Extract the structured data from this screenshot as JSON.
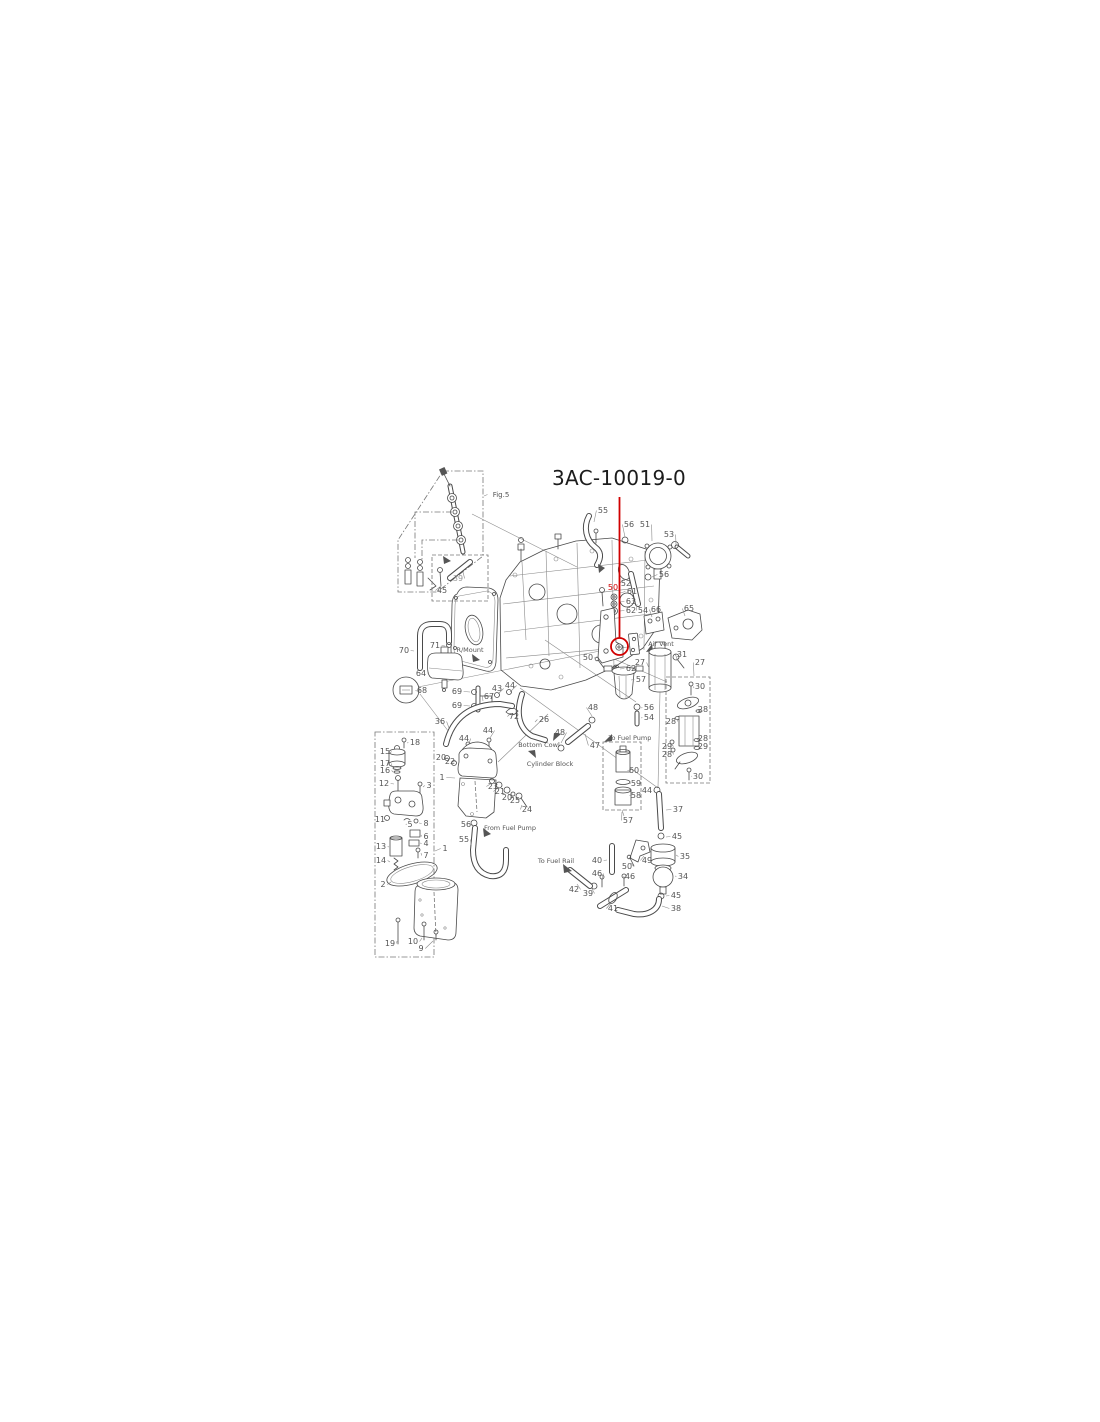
{
  "title": {
    "part_number": "3AC-10019-0"
  },
  "highlight": {
    "color": "#d10000",
    "leader_line": {
      "x": 619.5,
      "y1": 497,
      "y2": 637.5
    },
    "circle": {
      "x": 619.5,
      "y": 646.5,
      "r": 8.5
    },
    "highlighted_item": "50"
  },
  "labels": [
    {
      "t": "Fig.5",
      "x": 501,
      "y": 497,
      "fs": 7,
      "lx": 484,
      "ly": 496
    },
    {
      "t": "39",
      "x": 458,
      "y": 581,
      "c": "#999999",
      "lx": 463,
      "ly": 572
    },
    {
      "t": "45",
      "x": 442,
      "y": 593,
      "lx": 441,
      "ly": 586
    },
    {
      "t": "55",
      "x": 603,
      "y": 513,
      "lx": 594,
      "ly": 522
    },
    {
      "t": "56",
      "x": 629,
      "y": 527,
      "lx": 625,
      "ly": 537
    },
    {
      "t": "51",
      "x": 645,
      "y": 527,
      "lx": 652,
      "ly": 541
    },
    {
      "t": "53",
      "x": 669,
      "y": 537,
      "lx": 676,
      "ly": 545
    },
    {
      "t": "52",
      "x": 626,
      "y": 586,
      "lx": 624,
      "ly": 579
    },
    {
      "t": "56",
      "x": 664,
      "y": 577,
      "lx": 652,
      "ly": 577
    },
    {
      "t": "50",
      "x": 613,
      "y": 590,
      "c": "#d10000"
    },
    {
      "t": "61",
      "x": 632,
      "y": 594,
      "lx": 620,
      "ly": 593
    },
    {
      "t": "63",
      "x": 631,
      "y": 604,
      "lx": 620,
      "ly": 602
    },
    {
      "t": "62",
      "x": 631,
      "y": 613,
      "lx": 620,
      "ly": 611
    },
    {
      "t": "54",
      "x": 643,
      "y": 613,
      "lx": 637,
      "ly": 604
    },
    {
      "t": "66",
      "x": 656,
      "y": 612,
      "lx": 652,
      "ly": 617
    },
    {
      "t": "65",
      "x": 689,
      "y": 611,
      "lx": 685,
      "ly": 616
    },
    {
      "t": "Air Vent",
      "x": 661,
      "y": 646,
      "fs": 6.5
    },
    {
      "t": "50",
      "x": 588,
      "y": 660,
      "lx": 596,
      "ly": 661
    },
    {
      "t": "27",
      "x": 640,
      "y": 665,
      "lx": 649,
      "ly": 668
    },
    {
      "t": "62",
      "x": 631,
      "y": 671,
      "lx": 620,
      "ly": 669
    },
    {
      "t": "31",
      "x": 682,
      "y": 657,
      "lx": 678,
      "ly": 661
    },
    {
      "t": "27",
      "x": 700,
      "y": 665,
      "lx": 694,
      "ly": 676
    },
    {
      "t": "57",
      "x": 641,
      "y": 682,
      "lx": 631,
      "ly": 680
    },
    {
      "t": "56",
      "x": 649,
      "y": 710,
      "lx": 641,
      "ly": 708
    },
    {
      "t": "54",
      "x": 649,
      "y": 720,
      "lx": 641,
      "ly": 718
    },
    {
      "t": "To Fuel Pump",
      "x": 630,
      "y": 740,
      "fs": 6.5
    },
    {
      "t": "48",
      "x": 593,
      "y": 710,
      "lx": 592,
      "ly": 716
    },
    {
      "t": "47",
      "x": 595,
      "y": 748,
      "lx": 585,
      "ly": 734
    },
    {
      "t": "48",
      "x": 560,
      "y": 735,
      "lx": 561,
      "ly": 743
    },
    {
      "t": "26",
      "x": 544,
      "y": 722,
      "lx": 535,
      "ly": 722
    },
    {
      "t": "72",
      "x": 514,
      "y": 719,
      "lx": 510,
      "ly": 714
    },
    {
      "t": "Bottom Cowl",
      "x": 539,
      "y": 747,
      "fs": 6.5
    },
    {
      "t": "Cylinder Block",
      "x": 550,
      "y": 766,
      "fs": 6.5
    },
    {
      "t": "30",
      "x": 700,
      "y": 689,
      "lx": 694,
      "ly": 688
    },
    {
      "t": "28",
      "x": 703,
      "y": 712,
      "lx": 700,
      "ly": 711
    },
    {
      "t": "28",
      "x": 671,
      "y": 724,
      "lx": 677,
      "ly": 719
    },
    {
      "t": "28",
      "x": 703,
      "y": 741,
      "lx": 699,
      "ly": 741
    },
    {
      "t": "29",
      "x": 703,
      "y": 749,
      "lx": 699,
      "ly": 747
    },
    {
      "t": "29",
      "x": 667,
      "y": 749,
      "lx": 671,
      "ly": 744
    },
    {
      "t": "28",
      "x": 667,
      "y": 757,
      "lx": 672,
      "ly": 751
    },
    {
      "t": "30",
      "x": 698,
      "y": 779,
      "lx": 692,
      "ly": 776
    },
    {
      "t": "60",
      "x": 634,
      "y": 773,
      "lx": 630,
      "ly": 770
    },
    {
      "t": "59",
      "x": 636,
      "y": 786,
      "lx": 631,
      "ly": 783
    },
    {
      "t": "58",
      "x": 636,
      "y": 798,
      "lx": 632,
      "ly": 795
    },
    {
      "t": "57",
      "x": 628,
      "y": 823,
      "lx": 622,
      "ly": 812
    },
    {
      "t": "44",
      "x": 647,
      "y": 793,
      "lx": 654,
      "ly": 791
    },
    {
      "t": "37",
      "x": 678,
      "y": 812,
      "lx": 666,
      "ly": 810
    },
    {
      "t": "45",
      "x": 677,
      "y": 839,
      "lx": 666,
      "ly": 837
    },
    {
      "t": "35",
      "x": 685,
      "y": 859,
      "lx": 676,
      "ly": 855
    },
    {
      "t": "34",
      "x": 683,
      "y": 879,
      "lx": 675,
      "ly": 876
    },
    {
      "t": "45",
      "x": 676,
      "y": 898,
      "lx": 666,
      "ly": 896
    },
    {
      "t": "38",
      "x": 676,
      "y": 911,
      "lx": 662,
      "ly": 906
    },
    {
      "t": "40",
      "x": 597,
      "y": 863,
      "lx": 607,
      "ly": 860
    },
    {
      "t": "50",
      "x": 627,
      "y": 869,
      "lx": 631,
      "ly": 863
    },
    {
      "t": "49",
      "x": 647,
      "y": 863,
      "lx": 644,
      "ly": 856
    },
    {
      "t": "46",
      "x": 630,
      "y": 879,
      "lx": 626,
      "ly": 878
    },
    {
      "t": "46",
      "x": 597,
      "y": 876,
      "lx": 602,
      "ly": 879
    },
    {
      "t": "42",
      "x": 574,
      "y": 892,
      "lx": 577,
      "ly": 884
    },
    {
      "t": "39",
      "x": 588,
      "y": 896,
      "lx": 592,
      "ly": 889
    },
    {
      "t": "41",
      "x": 613,
      "y": 911,
      "lx": 611,
      "ly": 903
    },
    {
      "t": "To Fuel Rail",
      "x": 556,
      "y": 863,
      "fs": 6.5
    },
    {
      "t": "From Fuel Pump",
      "x": 510,
      "y": 830,
      "fs": 6.5
    },
    {
      "t": "56",
      "x": 466,
      "y": 827,
      "lx": 471,
      "ly": 824
    },
    {
      "t": "55",
      "x": 464,
      "y": 842,
      "lx": 471,
      "ly": 845
    },
    {
      "t": "70",
      "x": 404,
      "y": 653,
      "lx": 414,
      "ly": 651
    },
    {
      "t": "71",
      "x": 435,
      "y": 648,
      "lx": 445,
      "ly": 646
    },
    {
      "t": "R/Mount",
      "x": 470,
      "y": 652,
      "fs": 6.5
    },
    {
      "t": "64",
      "x": 421,
      "y": 676,
      "lx": 429,
      "ly": 673
    },
    {
      "t": "68",
      "x": 422,
      "y": 693,
      "lx": 417,
      "ly": 691
    },
    {
      "t": "69",
      "x": 457,
      "y": 694,
      "lx": 470,
      "ly": 692
    },
    {
      "t": "69",
      "x": 457,
      "y": 708,
      "lx": 470,
      "ly": 706
    },
    {
      "t": "67",
      "x": 489,
      "y": 699,
      "lx": 483,
      "ly": 701
    },
    {
      "t": "43",
      "x": 497,
      "y": 691,
      "lx": 498,
      "ly": 694
    },
    {
      "t": "44",
      "x": 510,
      "y": 688,
      "lx": 510,
      "ly": 692
    },
    {
      "t": "36",
      "x": 440,
      "y": 724,
      "lx": 449,
      "ly": 728
    },
    {
      "t": "44",
      "x": 488,
      "y": 733,
      "lx": 490,
      "ly": 738
    },
    {
      "t": "44",
      "x": 464,
      "y": 741,
      "lx": 469,
      "ly": 744
    },
    {
      "t": "20",
      "x": 441,
      "y": 760,
      "lx": 445,
      "ly": 759
    },
    {
      "t": "22",
      "x": 450,
      "y": 764,
      "lx": 453,
      "ly": 762
    },
    {
      "t": "1",
      "x": 442,
      "y": 780,
      "lx": 455,
      "ly": 778
    },
    {
      "t": "23",
      "x": 493,
      "y": 789,
      "lx": 492,
      "ly": 783
    },
    {
      "t": "21",
      "x": 500,
      "y": 794,
      "lx": 499,
      "ly": 787
    },
    {
      "t": "20",
      "x": 507,
      "y": 800,
      "lx": 507,
      "ly": 793
    },
    {
      "t": "25",
      "x": 515,
      "y": 803,
      "lx": 513,
      "ly": 797
    },
    {
      "t": "24",
      "x": 527,
      "y": 812,
      "lx": 522,
      "ly": 805
    },
    {
      "t": "18",
      "x": 415,
      "y": 745,
      "lx": 407,
      "ly": 743
    },
    {
      "t": "15",
      "x": 385,
      "y": 754,
      "lx": 390,
      "ly": 753
    },
    {
      "t": "17",
      "x": 385,
      "y": 766,
      "lx": 392,
      "ly": 767
    },
    {
      "t": "16",
      "x": 385,
      "y": 773,
      "lx": 393,
      "ly": 772
    },
    {
      "t": "12",
      "x": 384,
      "y": 786,
      "lx": 394,
      "ly": 784
    },
    {
      "t": "3",
      "x": 429,
      "y": 788,
      "lx": 423,
      "ly": 787
    },
    {
      "t": "11",
      "x": 380,
      "y": 822,
      "lx": 386,
      "ly": 820
    },
    {
      "t": "5",
      "x": 410,
      "y": 827,
      "lx": 407,
      "ly": 824
    },
    {
      "t": "8",
      "x": 426,
      "y": 826,
      "lx": 419,
      "ly": 823
    },
    {
      "t": "6",
      "x": 426,
      "y": 839,
      "lx": 421,
      "ly": 835
    },
    {
      "t": "4",
      "x": 426,
      "y": 846,
      "lx": 420,
      "ly": 843
    },
    {
      "t": "13",
      "x": 381,
      "y": 849,
      "lx": 389,
      "ly": 847
    },
    {
      "t": "7",
      "x": 426,
      "y": 858,
      "lx": 421,
      "ly": 853
    },
    {
      "t": "14",
      "x": 381,
      "y": 863,
      "lx": 390,
      "ly": 862
    },
    {
      "t": "2",
      "x": 383,
      "y": 887,
      "lx": 391,
      "ly": 882
    },
    {
      "t": "1",
      "x": 445,
      "y": 851,
      "lx": 435,
      "ly": 851
    },
    {
      "t": "19",
      "x": 390,
      "y": 946,
      "lx": 397,
      "ly": 941
    },
    {
      "t": "10",
      "x": 413,
      "y": 944,
      "lx": 422,
      "ly": 938
    },
    {
      "t": "9",
      "x": 421,
      "y": 951,
      "lx": 433,
      "ly": 941
    }
  ]
}
